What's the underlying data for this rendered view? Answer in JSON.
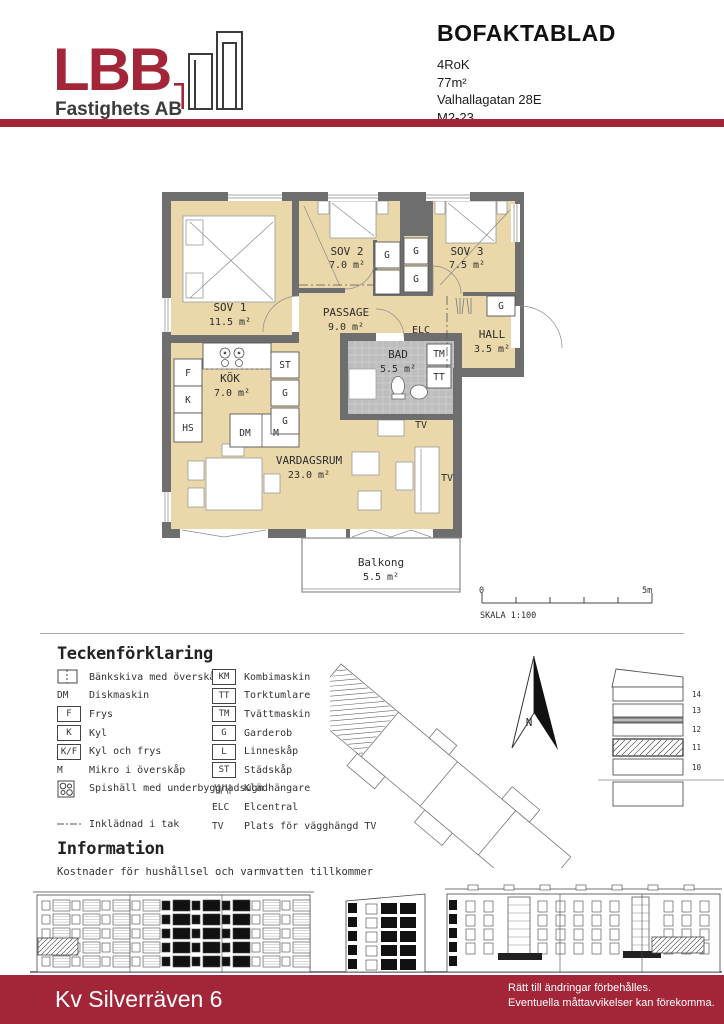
{
  "header": {
    "logo_text": "LBB",
    "logo_subtext": "Fastighets AB",
    "title": "BOFAKTABLAD",
    "details": [
      "4RoK",
      "77m²",
      "Valhallagatan 28E",
      "M2-23"
    ]
  },
  "colors": {
    "brand_red": "#A32638",
    "floor_beige": "#EBD8AA",
    "wall_gray": "#6E6E6E",
    "bath_gray": "#BDBDBD"
  },
  "plan": {
    "rooms": {
      "sov1": {
        "name": "SOV 1",
        "area": "11.5 m²"
      },
      "sov2": {
        "name": "SOV 2",
        "area": "7.0 m²"
      },
      "sov3": {
        "name": "SOV 3",
        "area": "7.5 m²"
      },
      "passage": {
        "name": "PASSAGE",
        "area": "9.0 m²"
      },
      "hall": {
        "name": "HALL",
        "area": "3.5 m²"
      },
      "bad": {
        "name": "BAD",
        "area": "5.5 m²"
      },
      "kok": {
        "name": "KÖK",
        "area": "7.0 m²"
      },
      "vardagsrum": {
        "name": "VARDAGSRUM",
        "area": "23.0 m²"
      },
      "balkong": {
        "name": "Balkong",
        "area": "5.5 m²"
      }
    },
    "fixtures": {
      "f": "F",
      "k": "K",
      "hs": "HS",
      "dm": "DM",
      "m": "M",
      "st": "ST",
      "g": "G",
      "tm": "TM",
      "tt": "TT",
      "elc": "ELC",
      "tv": "TV"
    }
  },
  "scalebar": {
    "start": "0",
    "end": "5m",
    "label": "SKALA 1:100"
  },
  "legend": {
    "title": "Teckenförklaring",
    "left": [
      {
        "sym": "counter",
        "key": "",
        "label": "Bänkskiva med överskåp"
      },
      {
        "sym": "key",
        "key": "DM",
        "label": "Diskmaskin"
      },
      {
        "sym": "box",
        "key": "F",
        "label": "Frys"
      },
      {
        "sym": "box",
        "key": "K",
        "label": "Kyl"
      },
      {
        "sym": "box",
        "key": "K/F",
        "label": "Kyl och frys"
      },
      {
        "sym": "key",
        "key": "M",
        "label": "Mikro i överskåp"
      },
      {
        "sym": "stove",
        "key": "",
        "label": "Spishäll med underbyggnadsugn"
      },
      {
        "sym": "dashdot",
        "key": "",
        "label": "Inklädnad i tak"
      }
    ],
    "right": [
      {
        "sym": "box",
        "key": "KM",
        "label": "Kombimaskin"
      },
      {
        "sym": "box",
        "key": "TT",
        "label": "Torktumlare"
      },
      {
        "sym": "box",
        "key": "TM",
        "label": "Tvättmaskin"
      },
      {
        "sym": "box",
        "key": "G",
        "label": "Garderob"
      },
      {
        "sym": "box",
        "key": "L",
        "label": "Linneskåp"
      },
      {
        "sym": "box",
        "key": "ST",
        "label": "Städskåp"
      },
      {
        "sym": "hanger",
        "key": "",
        "label": "Klädhängare"
      },
      {
        "sym": "key",
        "key": "ELC",
        "label": "Elcentral"
      },
      {
        "sym": "key",
        "key": "TV",
        "label": "Plats för vägghängd TV"
      }
    ]
  },
  "siteplan": {
    "north_label": "N"
  },
  "section": {
    "floors": [
      "14",
      "13",
      "12",
      "11",
      "10"
    ]
  },
  "information": {
    "title": "Information",
    "text": "Kostnader för hushållsel och varmvatten tillkommer"
  },
  "footer": {
    "project": "Kv Silverräven 6",
    "note1": "Rätt till ändringar förbehålles.",
    "note2": "Eventuella måttavvikelser kan förekomma."
  }
}
